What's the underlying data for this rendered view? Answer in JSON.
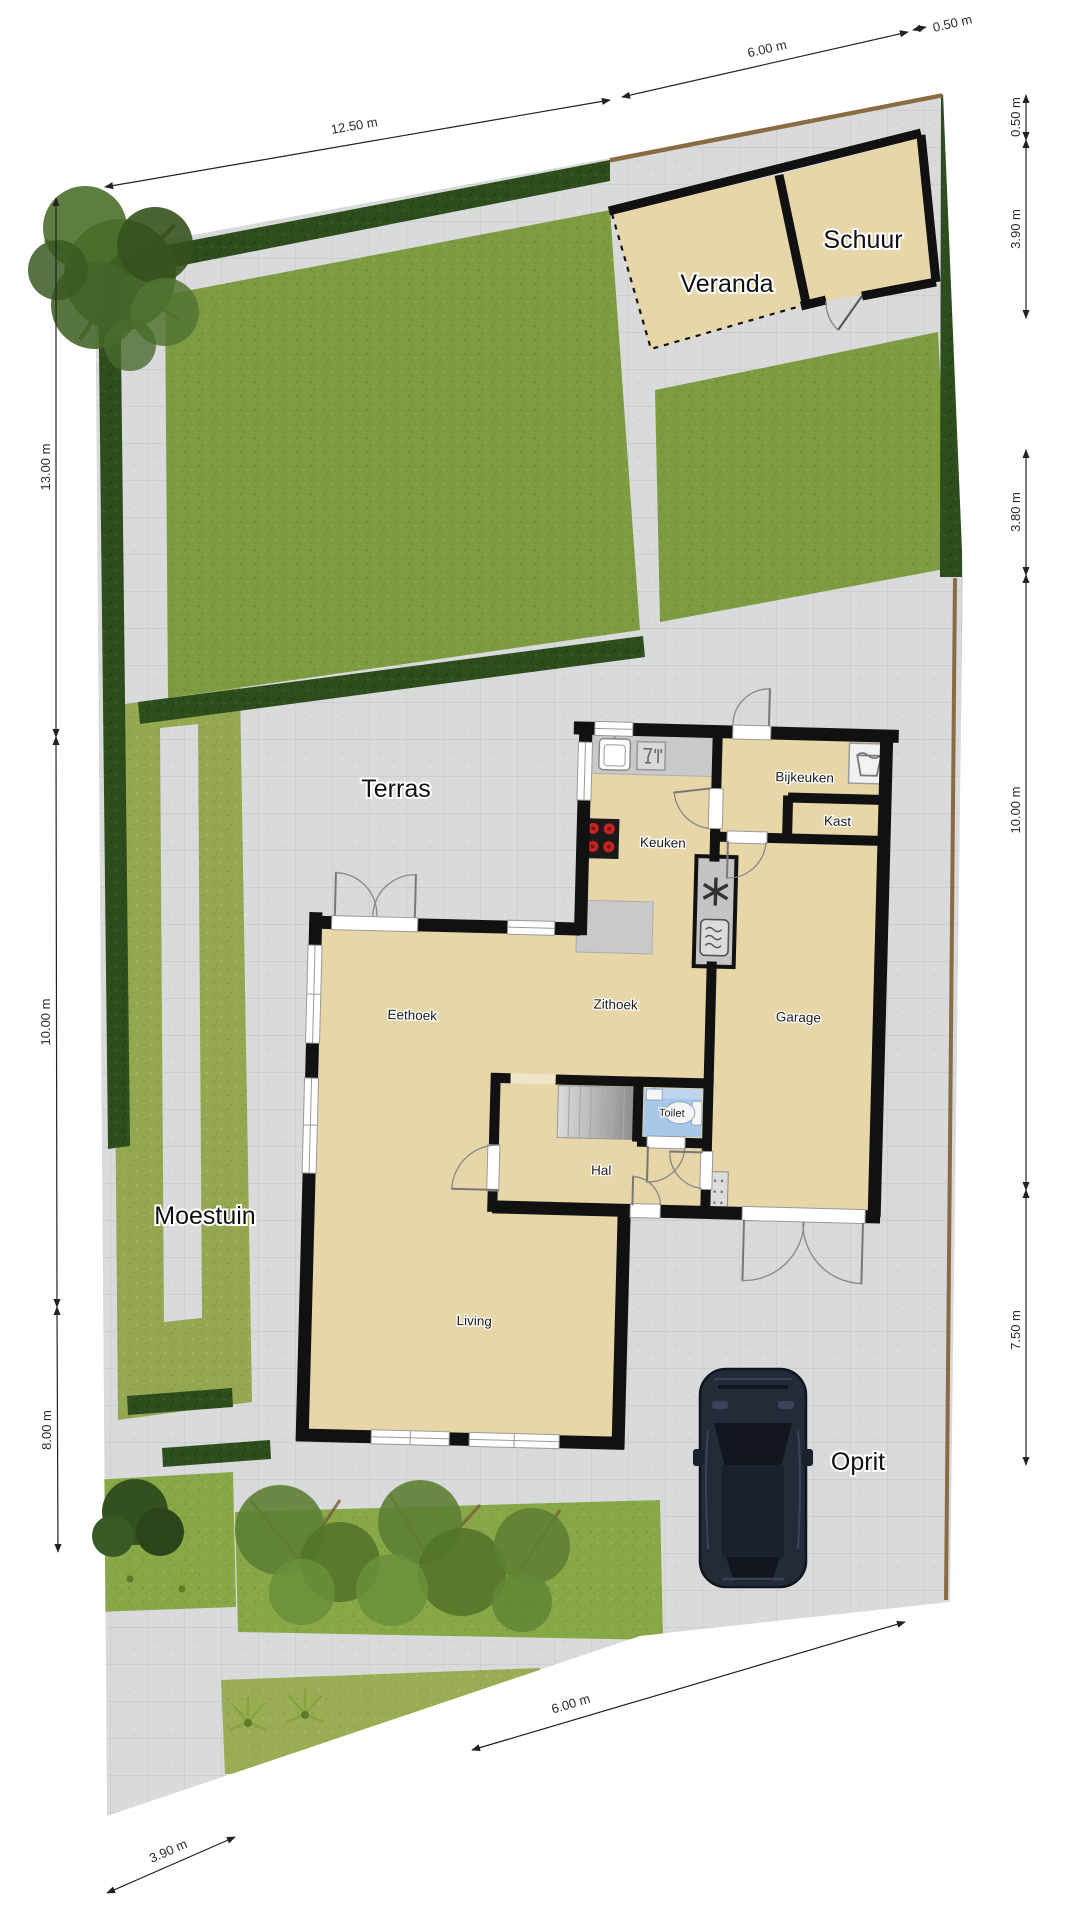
{
  "plan": {
    "title": "Situatie plattegrond",
    "site_labels": {
      "terras": "Terras",
      "moestuin": "Moestuin",
      "oprit": "Oprit"
    },
    "buildings": {
      "veranda": "Veranda",
      "schuur": "Schuur"
    },
    "rooms": {
      "keuken": "Keuken",
      "bijkeuken": "Bijkeuken",
      "kast": "Kast",
      "zithoek": "Zithoek",
      "eethoek": "Eethoek",
      "garage": "Garage",
      "toilet": "Toilet",
      "hal": "Hal",
      "living": "Living"
    },
    "dimensions": {
      "top": [
        "12.50 m",
        "6.00 m",
        "0.50 m"
      ],
      "left": [
        "13.00 m",
        "10.00 m",
        "8.00 m"
      ],
      "right": [
        "0.50 m",
        "3.90 m",
        "3.80 m",
        "10.00 m",
        "7.50 m"
      ],
      "bottom": [
        "6.00 m",
        "3.90 m"
      ]
    },
    "colors": {
      "pavement": "#d9dadb",
      "grass": "#7d9c42",
      "hedge": "#2e4d1d",
      "floor": "#e7d6a8",
      "wall": "#111111",
      "toilet_room": "#a9c7e8",
      "stove_burner": "#cc2222",
      "car_body": "#232a38",
      "fence": "#8a6b42",
      "moestuin": "#93a851"
    }
  }
}
